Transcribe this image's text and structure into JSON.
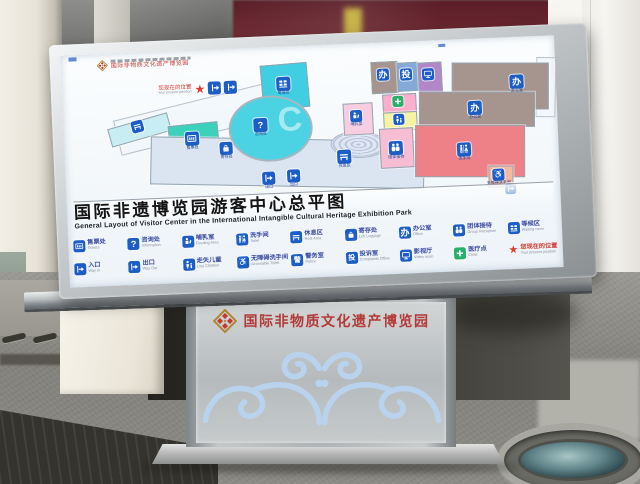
{
  "board": {
    "logo": {
      "zh": "国际非物质文化遗产博览园"
    },
    "you_are_here": {
      "zh": "您现在的位置",
      "en": "Your present position"
    },
    "title": {
      "zh": "国际非遗博览园游客中心总平图",
      "en": "General Layout of Visitor Center in the International Intangible Cultural Heritage Exhibition Park"
    },
    "legend": {
      "row1": [
        {
          "zh": "售票处",
          "en": "Tickets",
          "icon": "ticket-window-icon"
        },
        {
          "zh": "咨询处",
          "en": "Information",
          "icon": "question-icon",
          "glyph": "?"
        },
        {
          "zh": "哺乳室",
          "en": "Feeding Area",
          "icon": "feeding-icon"
        },
        {
          "zh": "洗手间",
          "en": "Toilet",
          "icon": "toilet-icon"
        },
        {
          "zh": "休息区",
          "en": "Rest Area",
          "icon": "bench-icon"
        },
        {
          "zh": "寄存处",
          "en": "Left Luggage",
          "icon": "luggage-icon"
        },
        {
          "zh": "办公室",
          "en": "Office",
          "icon": "office-icon",
          "glyph": "办"
        },
        {
          "zh": "团体接待",
          "en": "Group Reception",
          "icon": "group-icon"
        },
        {
          "zh": "等候区",
          "en": "Waiting room",
          "icon": "seats-icon"
        }
      ],
      "row2": [
        {
          "zh": "入口",
          "en": "Way In",
          "icon": "door-arrow-icon"
        },
        {
          "zh": "出口",
          "en": "Way Out",
          "icon": "door-arrow-icon"
        },
        {
          "zh": "走失儿童",
          "en": "Lost Children",
          "icon": "child-icon"
        },
        {
          "zh": "无障碍洗手间",
          "en": "Accessible Toilet",
          "icon": "wheelchair-icon",
          "glyph": "♿"
        },
        {
          "zh": "警务室",
          "en": "Police",
          "icon": "police-icon",
          "glyph": "警"
        },
        {
          "zh": "投诉室",
          "en": "Complaints Office",
          "icon": "complaints-icon",
          "glyph": "投"
        },
        {
          "zh": "影视厅",
          "en": "Video room",
          "icon": "screen-icon"
        },
        {
          "zh": "医疗点",
          "en": "Clinic",
          "icon": "medical-cross-icon"
        },
        {
          "zh": "您现在的位置",
          "en": "Your present position",
          "icon": "star-icon",
          "glyph": "★"
        }
      ]
    },
    "map": {
      "rooms": [
        {
          "name": "rest-area-west",
          "label": "休息区"
        },
        {
          "name": "tickets",
          "label": "售票处"
        },
        {
          "name": "waiting-area",
          "label": "等候区"
        },
        {
          "name": "information",
          "label": "咨询处",
          "glyph": "?"
        },
        {
          "name": "left-luggage",
          "label": "寄存处"
        },
        {
          "name": "rest-area-lobby",
          "label": "休息区"
        },
        {
          "name": "feeding-room",
          "label": "哺乳室"
        },
        {
          "name": "clinic",
          "label": "医疗点"
        },
        {
          "name": "lost-children",
          "label": "走失儿童"
        },
        {
          "name": "office-1",
          "label": "办公室",
          "glyph": "办"
        },
        {
          "name": "complaints-office",
          "label": "投诉室",
          "glyph": "投"
        },
        {
          "name": "video-room",
          "label": "影视厅"
        },
        {
          "name": "office-2",
          "label": "办公室",
          "glyph": "办"
        },
        {
          "name": "office-3",
          "label": "办公室",
          "glyph": "办"
        },
        {
          "name": "group-reception",
          "label": "团体接待"
        },
        {
          "name": "toilet",
          "label": "洗手间"
        },
        {
          "name": "accessible-toilet",
          "label": "无障碍洗手间",
          "glyph": "♿"
        },
        {
          "name": "entrance",
          "label": "入口"
        },
        {
          "name": "exit",
          "label": "出口"
        }
      ]
    }
  },
  "pedestal": {
    "title": "国际非物质文化遗产博览园"
  },
  "colors": {
    "map_icon_blue": "#1d5ec6",
    "star_red": "#e23b2e",
    "clinic_green": "#27b06a",
    "legend_text_blue": "#3b4aa0",
    "pedestal_text_red": "#b23a38",
    "ornament_blue": "#b9d3ee",
    "maroon_window": "#5a1d26"
  }
}
